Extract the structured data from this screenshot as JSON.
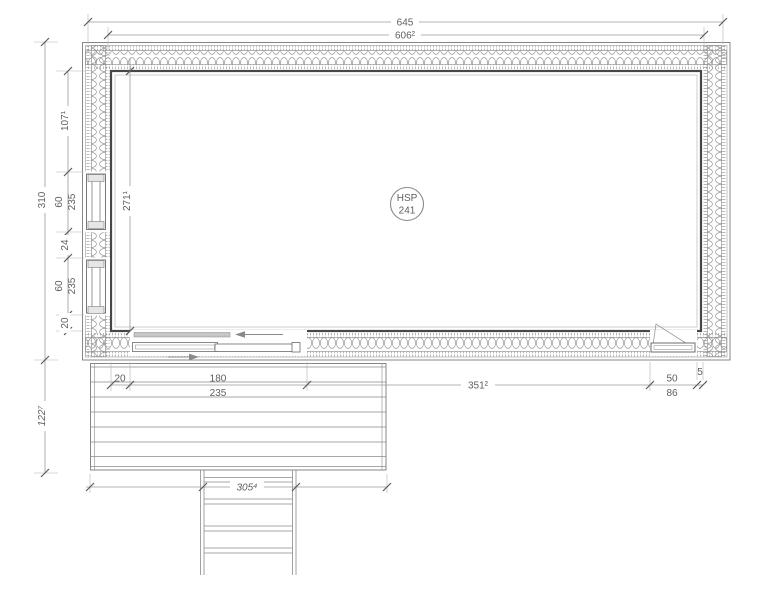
{
  "stamp": {
    "code": "HSP",
    "number": "241"
  },
  "dims": {
    "top_overall": "645",
    "top_inner": "606²",
    "left_overall": "310",
    "left_wall_top": "107¹",
    "left_win1_w": "60",
    "left_win1_h": "235",
    "left_pier": "24",
    "left_win2_w": "60",
    "left_win2_h": "235",
    "left_wall_bottom": "20",
    "interior_depth": "271¹",
    "terrace_depth": "122⁷",
    "bottom_offset": "20",
    "slide_door_w": "180",
    "slide_door_h": "235",
    "bottom_wall": "351²",
    "door_w": "50",
    "door_h": "86",
    "corner_gap": "5",
    "terrace_width": "305⁴"
  }
}
